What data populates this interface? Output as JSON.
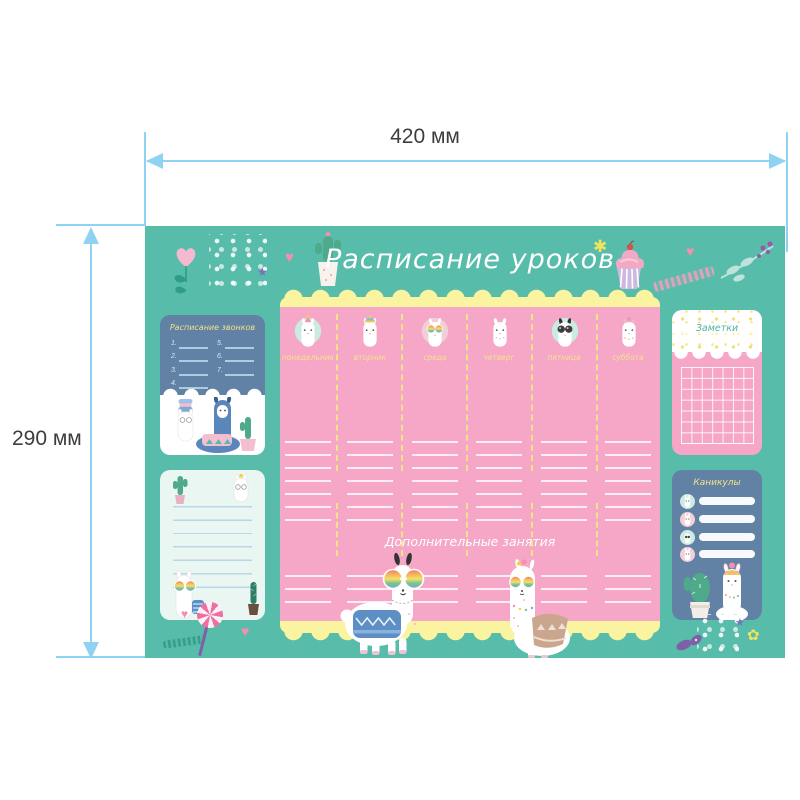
{
  "dimensions": {
    "width_label": "420 мм",
    "height_label": "290 мм"
  },
  "mat": {
    "title": "Расписание уроков",
    "extra_title": "Дополнительные занятия",
    "days": [
      {
        "label": "понедельник",
        "icon": "llama-party-hat-icon"
      },
      {
        "label": "вторник",
        "icon": "llama-beanie-icon"
      },
      {
        "label": "среда",
        "icon": "llama-rainbow-glasses-icon"
      },
      {
        "label": "четверг",
        "icon": "llama-plain-icon"
      },
      {
        "label": "пятница",
        "icon": "llama-sunglasses-icon"
      },
      {
        "label": "суббота",
        "icon": "llama-pink-ears-icon"
      }
    ],
    "bells_card": {
      "title": "Расписание звонков",
      "numbers_left": [
        "1.",
        "2.",
        "3.",
        "4."
      ],
      "numbers_right": [
        "5.",
        "6.",
        "7."
      ]
    },
    "notes_card": {
      "title": "Заметки"
    },
    "holidays_card": {
      "title": "Каникулы"
    }
  },
  "icons": {
    "heart": "♥",
    "star": "★",
    "asterisk": "✱",
    "flower": "✿"
  },
  "colors": {
    "mat_teal": "#58BCAB",
    "schedule_pink": "#F6A6C6",
    "scallop_yellow": "#FAF4A0",
    "card_blue": "#6182A5",
    "mint_card": "#EAF6F1",
    "dimension_blue": "#8FD2F4",
    "day_label_yellow": "#F2E38C"
  }
}
